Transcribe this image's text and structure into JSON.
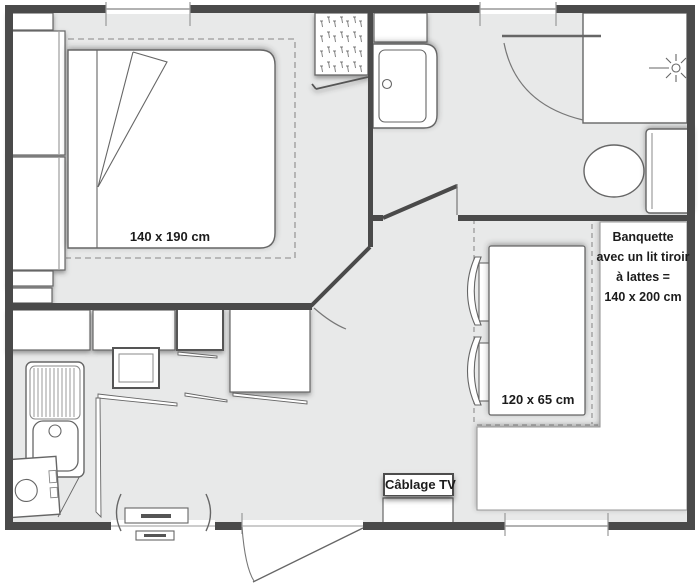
{
  "title": "Mobile-home floor plan",
  "labels": {
    "bed_dimensions": "140 x 190 cm",
    "table_dimensions": "120 x 65 cm",
    "tv_cabling": "Câblage TV",
    "banquette": {
      "line1": "Banquette",
      "line2": "avec un lit tiroir",
      "line3": "à lattes =",
      "line4": "140 x 200 cm"
    }
  },
  "colors": {
    "wall": "#4a4a4a",
    "floor": "#e8e9e9",
    "outline": "#666666",
    "dashed_line": "#9a9a9a",
    "fixture_fill": "#ffffff",
    "label_text": "#1c1c1c"
  },
  "rooms": [
    {
      "name": "bedroom"
    },
    {
      "name": "bathroom"
    },
    {
      "name": "kitchen"
    },
    {
      "name": "living-dining"
    }
  ],
  "fixtures": [
    "double-bed",
    "wardrobe-column",
    "hatched-closet",
    "bathroom-cabinet",
    "washbasin",
    "shower",
    "toilet",
    "kitchen-counters",
    "hob",
    "oven",
    "kitchen-sink",
    "fridge",
    "dining-table",
    "chair",
    "chair",
    "banquette-bench",
    "tv-cabling-box",
    "entry-door",
    "entry-step",
    "window",
    "window",
    "window"
  ]
}
